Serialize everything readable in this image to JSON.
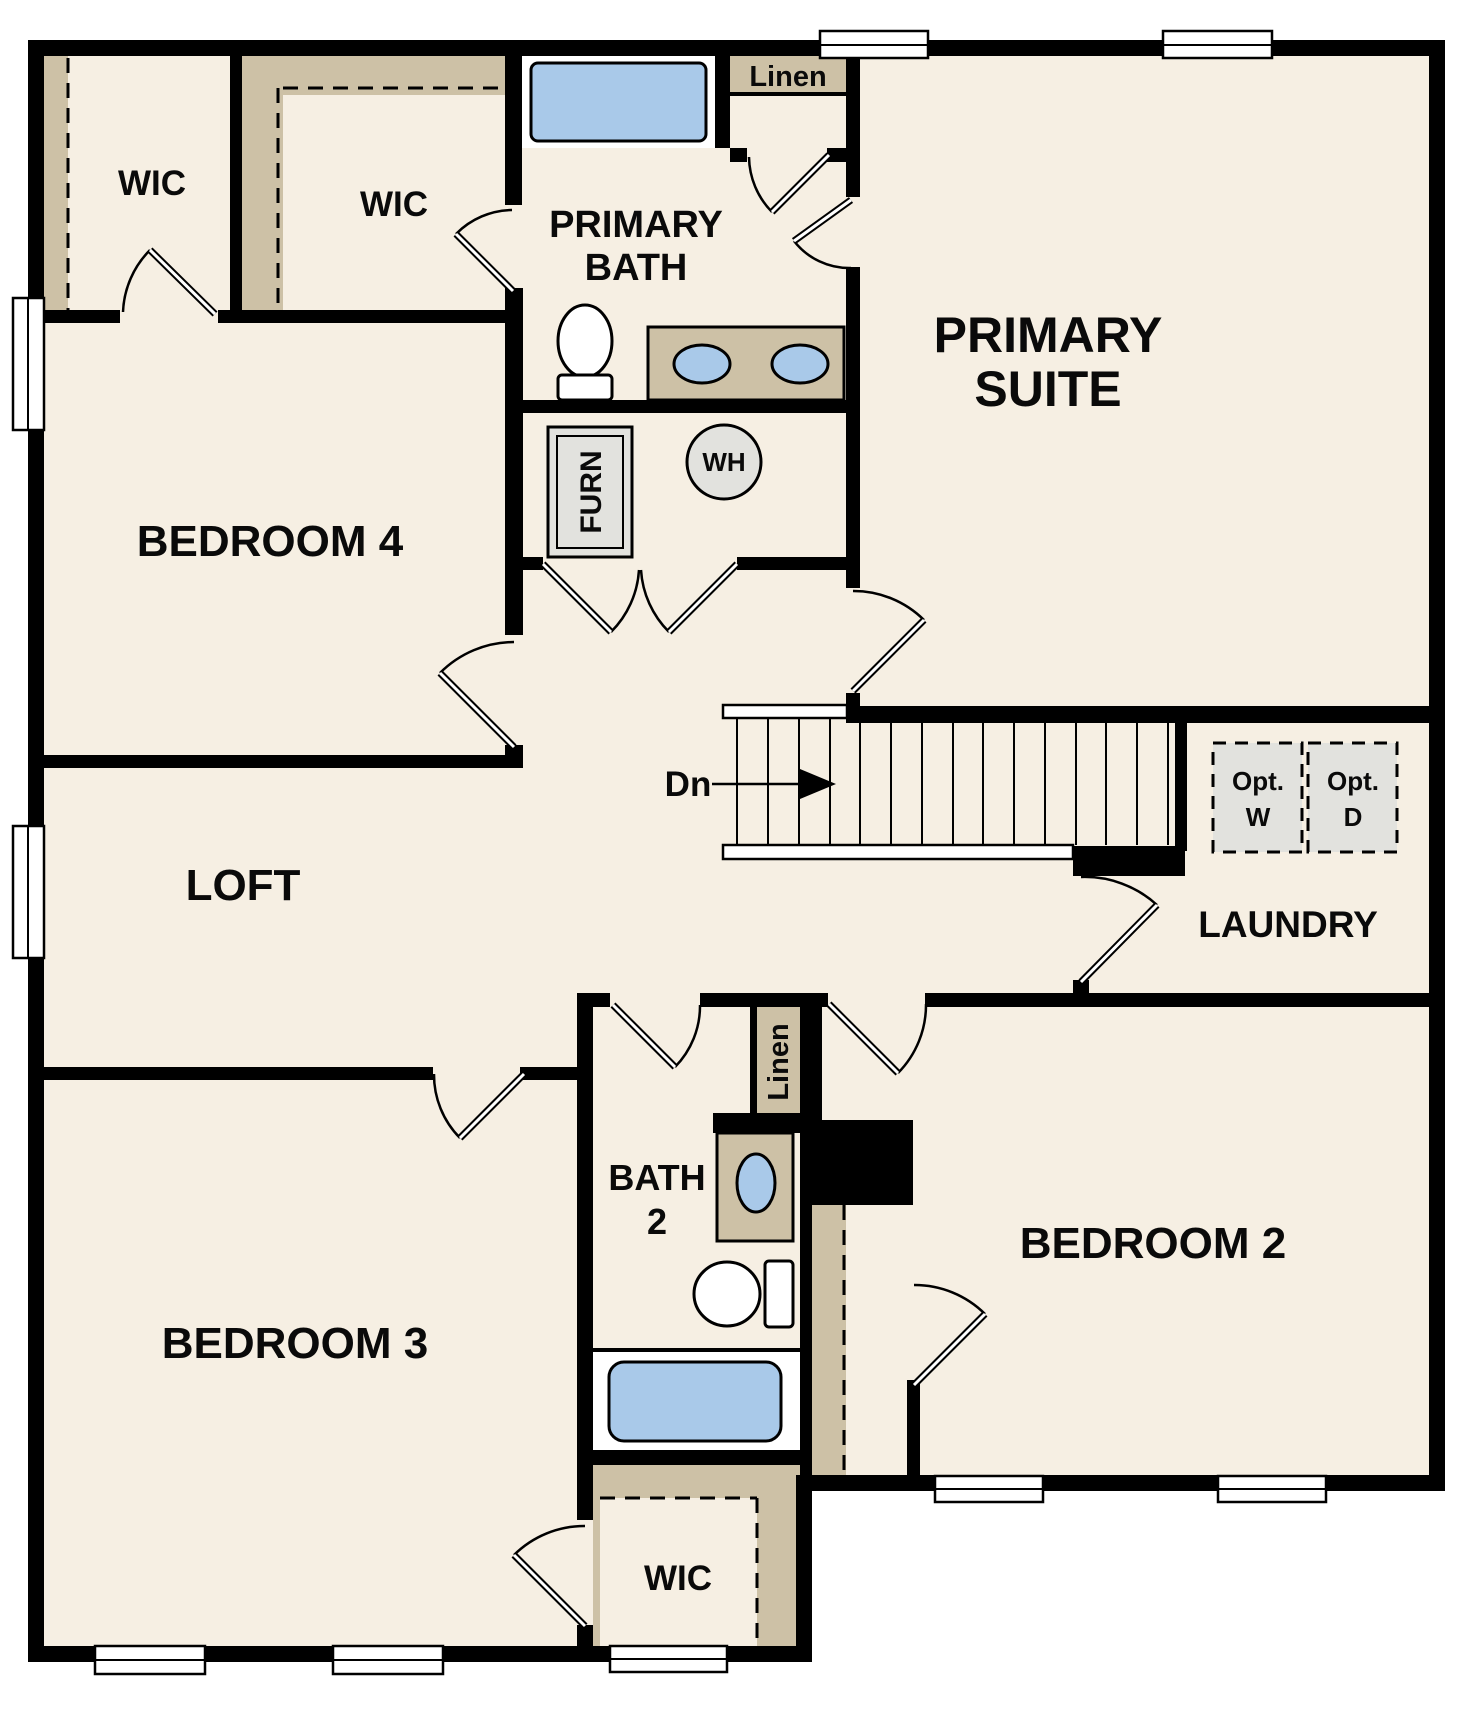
{
  "title": "Second floor residential floor plan",
  "labels": {
    "wic_top_left": "WIC",
    "wic_top_mid": "WIC",
    "primary_bath_line1": "PRIMARY",
    "primary_bath_line2": "BATH",
    "linen_top": "Linen",
    "primary_suite_line1": "PRIMARY",
    "primary_suite_line2": "SUITE",
    "bedroom4": "BEDROOM 4",
    "furn": "FURN",
    "wh": "WH",
    "dn": "Dn",
    "opt_w_line1": "Opt.",
    "opt_w_line2": "W",
    "opt_d_line1": "Opt.",
    "opt_d_line2": "D",
    "laundry": "LAUNDRY",
    "loft": "LOFT",
    "bath2_line1": "BATH",
    "bath2_line2": "2",
    "linen_bath2": "Linen",
    "bedroom2": "BEDROOM 2",
    "bedroom3": "BEDROOM 3",
    "wic_bottom": "WIC"
  },
  "colors": {
    "background": "#ffffff",
    "floor": "#f6efe3",
    "wall": "#000000",
    "closet_shelving": "#cdc1a6",
    "plumbing_fixture_blue": "#a9c9e9",
    "appliance_gray": "#e2e2de"
  }
}
